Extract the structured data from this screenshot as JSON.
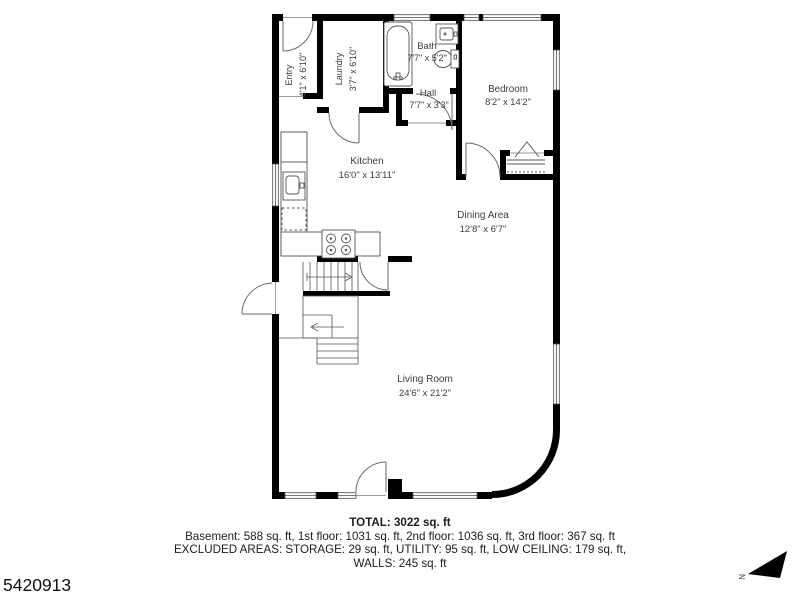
{
  "plan_id": "5420913",
  "compass": {
    "label": "N"
  },
  "rooms": {
    "entry": {
      "name": "Entry",
      "dims": "4'1\" x 6'10\""
    },
    "laundry": {
      "name": "Laundry",
      "dims": "3'7\" x 6'10\""
    },
    "bath": {
      "name": "Bath",
      "dims": "7'7\" x 5'2\""
    },
    "hall": {
      "name": "Hall",
      "dims": "7'7\" x 3'3\""
    },
    "bedroom": {
      "name": "Bedroom",
      "dims": "8'2\" x 14'2\""
    },
    "kitchen": {
      "name": "Kitchen",
      "dims": "16'0\" x 13'11\""
    },
    "dining": {
      "name": "Dining Area",
      "dims": "12'8\" x 6'7\""
    },
    "living": {
      "name": "Living Room",
      "dims": "24'6\" x 21'2\""
    }
  },
  "summary": {
    "total": "TOTAL: 3022 sq. ft",
    "floors": "Basement: 588 sq. ft, 1st floor: 1031 sq. ft, 2nd floor: 1036 sq. ft, 3rd floor: 367 sq. ft",
    "excluded": "EXCLUDED AREAS: STORAGE: 29 sq. ft, UTILITY: 95 sq. ft, LOW CEILING: 179 sq. ft,",
    "walls": "WALLS: 245 sq. ft"
  }
}
